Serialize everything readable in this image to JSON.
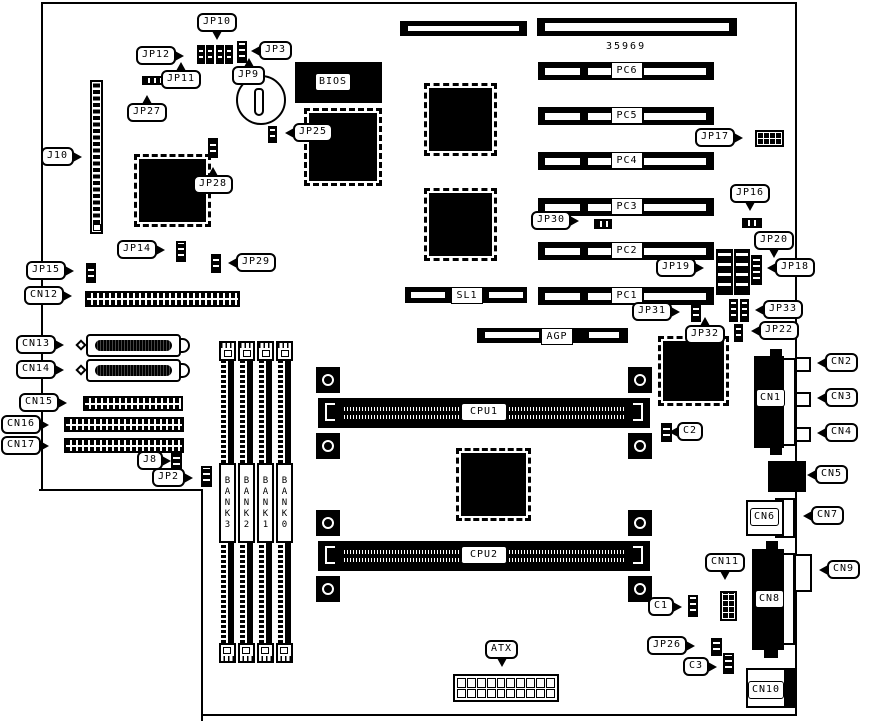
{
  "board": {
    "part_number": "35969",
    "colors": {
      "line": "#000000",
      "background": "#ffffff"
    },
    "callouts": {
      "jp10": "JP10",
      "jp12": "JP12",
      "jp11": "JP11",
      "jp9": "JP9",
      "jp3": "JP3",
      "jp27": "JP27",
      "j10": "J10",
      "jp25": "JP25",
      "jp28": "JP28",
      "jp14": "JP14",
      "jp29": "JP29",
      "jp15": "JP15",
      "cn12": "CN12",
      "cn13": "CN13",
      "cn14": "CN14",
      "cn15": "CN15",
      "cn16": "CN16",
      "cn17": "CN17",
      "j8": "J8",
      "jp2": "JP2",
      "jp30": "JP30",
      "jp17": "JP17",
      "jp16": "JP16",
      "jp20": "JP20",
      "jp19": "JP19",
      "jp18": "JP18",
      "jp31": "JP31",
      "jp33": "JP33",
      "jp32": "JP32",
      "jp22": "JP22",
      "cn2": "CN2",
      "cn3": "CN3",
      "cn4": "CN4",
      "cn5": "CN5",
      "cn7": "CN7",
      "cn9": "CN9",
      "cn11": "CN11",
      "c1": "C1",
      "c2": "C2",
      "jp26": "JP26",
      "c3": "C3",
      "atx": "ATX"
    },
    "slots": {
      "pc6": "PC6",
      "pc5": "PC5",
      "pc4": "PC4",
      "pc3": "PC3",
      "pc2": "PC2",
      "pc1": "PC1",
      "sl1": "SL1",
      "agp": "AGP"
    },
    "chips": {
      "bios": "BIOS"
    },
    "cpu_slots": {
      "cpu1": "CPU1",
      "cpu2": "CPU2"
    },
    "banks": {
      "bank3": "BANK3",
      "bank2": "BANK2",
      "bank1": "BANK1",
      "bank0": "BANK0"
    },
    "connectors": {
      "cn1": "CN1",
      "cn6": "CN6",
      "cn8": "CN8",
      "cn10": "CN10"
    }
  }
}
